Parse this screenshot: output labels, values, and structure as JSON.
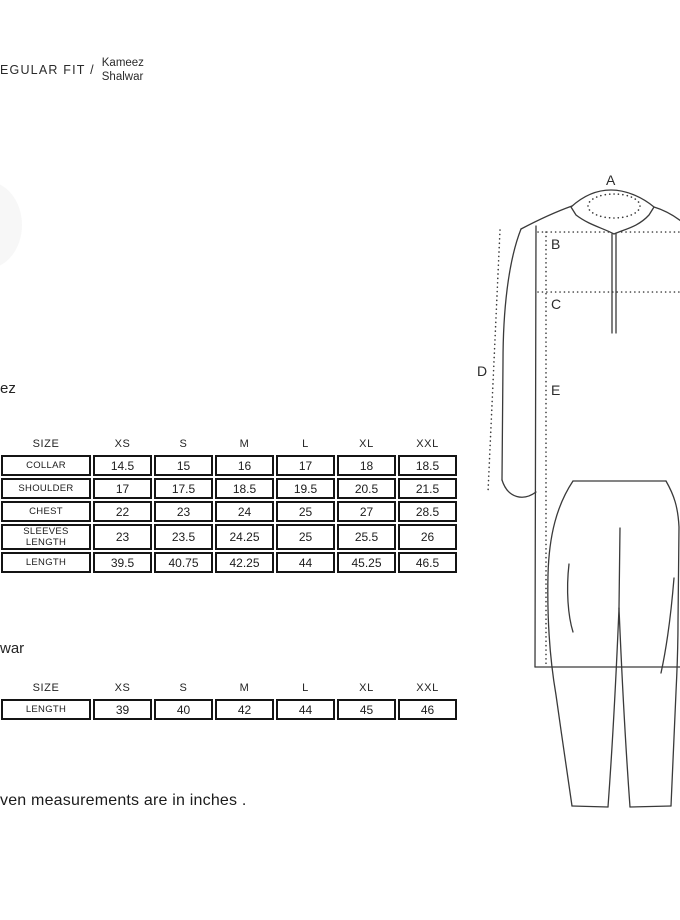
{
  "header": {
    "brand_prefix": "EGULAR FIT /",
    "product_line1": "Kameez",
    "product_line2": "Shalwar"
  },
  "kameez_section": {
    "heading": "ez",
    "table": {
      "columns": [
        "SIZE",
        "XS",
        "S",
        "M",
        "L",
        "XL",
        "XXL"
      ],
      "rows": [
        {
          "label": "COLLAR",
          "values": [
            "14.5",
            "15",
            "16",
            "17",
            "18",
            "18.5"
          ]
        },
        {
          "label": "SHOULDER",
          "values": [
            "17",
            "17.5",
            "18.5",
            "19.5",
            "20.5",
            "21.5"
          ]
        },
        {
          "label": "CHEST",
          "values": [
            "22",
            "23",
            "24",
            "25",
            "27",
            "28.5"
          ]
        },
        {
          "label": "SLEEVES LENGTH",
          "values": [
            "23",
            "23.5",
            "24.25",
            "25",
            "25.5",
            "26"
          ]
        },
        {
          "label": "LENGTH",
          "values": [
            "39.5",
            "40.75",
            "42.25",
            "44",
            "45.25",
            "46.5"
          ]
        }
      ]
    }
  },
  "shalwar_section": {
    "heading": "war",
    "table": {
      "columns": [
        "SIZE",
        "XS",
        "S",
        "M",
        "L",
        "XL",
        "XXL"
      ],
      "rows": [
        {
          "label": "LENGTH",
          "values": [
            "39",
            "40",
            "42",
            "44",
            "45",
            "46"
          ]
        }
      ]
    }
  },
  "note": "ven measurements are in inches .",
  "diagram": {
    "labels": {
      "a": "A",
      "b": "B",
      "c": "C",
      "d": "D",
      "e": "E"
    },
    "line_color": "#3a3a3a"
  }
}
